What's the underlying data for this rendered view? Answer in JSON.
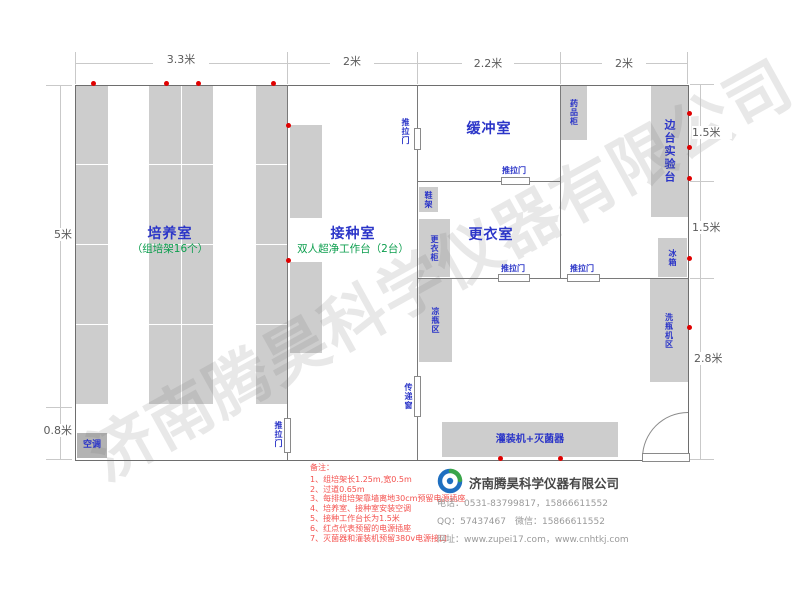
{
  "watermark": "济南腾昊科学仪器有限公司",
  "dims": {
    "top": [
      "3.3米",
      "2米",
      "2.2米",
      "2米"
    ],
    "left": [
      "5米",
      "0.8米"
    ],
    "right": [
      "1.5米",
      "1.5米",
      "2.8米"
    ]
  },
  "rooms": {
    "cultivation": "培养室",
    "cultivation_sub": "（组培架16个）",
    "inoculation": "接种室",
    "inoculation_sub": "双人超净工作台（2台）",
    "buffer": "缓冲室",
    "changing": "更衣室"
  },
  "fixtures": {
    "sliding_door": "推拉门",
    "transfer_window": "传递窗",
    "shoe_rack": "鞋架",
    "wardrobe": "更衣柜",
    "cool_bottle_area": "凉瓶区",
    "medicine_cabinet": "药品柜",
    "side_bench": "边台实验台",
    "fridge": "冰箱",
    "bottle_washer_area": "洗瓶机区",
    "filler_sterilizer": "灌装机+灭菌器",
    "air_conditioner": "空调"
  },
  "notes": {
    "heading": "备注：",
    "items": [
      "1、组培架长1.25m,宽0.5m",
      "2、过道0.65m",
      "3、每排组培架靠墙离地30cm预留电源插座",
      "4、培养室、接种室安装空调",
      "5、接种工作台长为1.5米",
      "6、红点代表预留的电源插座",
      "7、灭菌器和灌装机预留380v电源接口"
    ]
  },
  "company": {
    "name": "济南腾昊科学仪器有限公司",
    "phone": "电话：0531-83799817，15866611552",
    "qq": "QQ：57437467　微信：15866611552",
    "web": "网址：www.zupei17.com，www.cnhtkj.com"
  },
  "colors": {
    "room_label": "#2b35c8",
    "sub_label": "#0b9e4d",
    "socket_dot": "#e00000",
    "note_text": "#f4514e",
    "equipment_fill": "#cdcdcd"
  }
}
